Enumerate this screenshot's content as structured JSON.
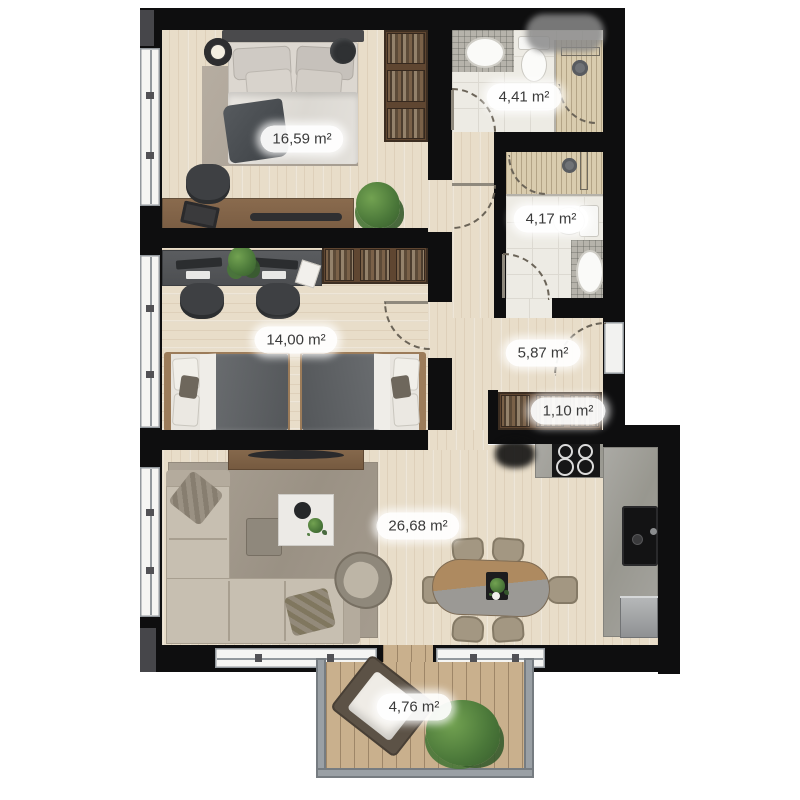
{
  "title": "Apartment floor plan",
  "units": "m²",
  "rooms": {
    "bedroom1": {
      "area": "16,59 m²"
    },
    "bathroom1": {
      "area": "4,41 m²"
    },
    "bathroom2": {
      "area": "4,17 m²"
    },
    "bedroom2": {
      "area": "14,00 m²"
    },
    "hallway": {
      "area": "5,87 m²"
    },
    "closet": {
      "area": "1,10 m²"
    },
    "living_kitchen": {
      "area": "26,68 m²"
    },
    "balcony": {
      "area": "4,76 m²"
    }
  },
  "colors": {
    "wall": "#0e0e0f",
    "wood_floor": "#e8ddc9",
    "bathroom_tile": "#edebe4",
    "shower_tile": "#d9ccae",
    "kitchen_counter": "#a09f9a",
    "balcony_deck": "#c9b08d",
    "label_background": "#ffffff",
    "label_text": "#3a3a3a"
  }
}
